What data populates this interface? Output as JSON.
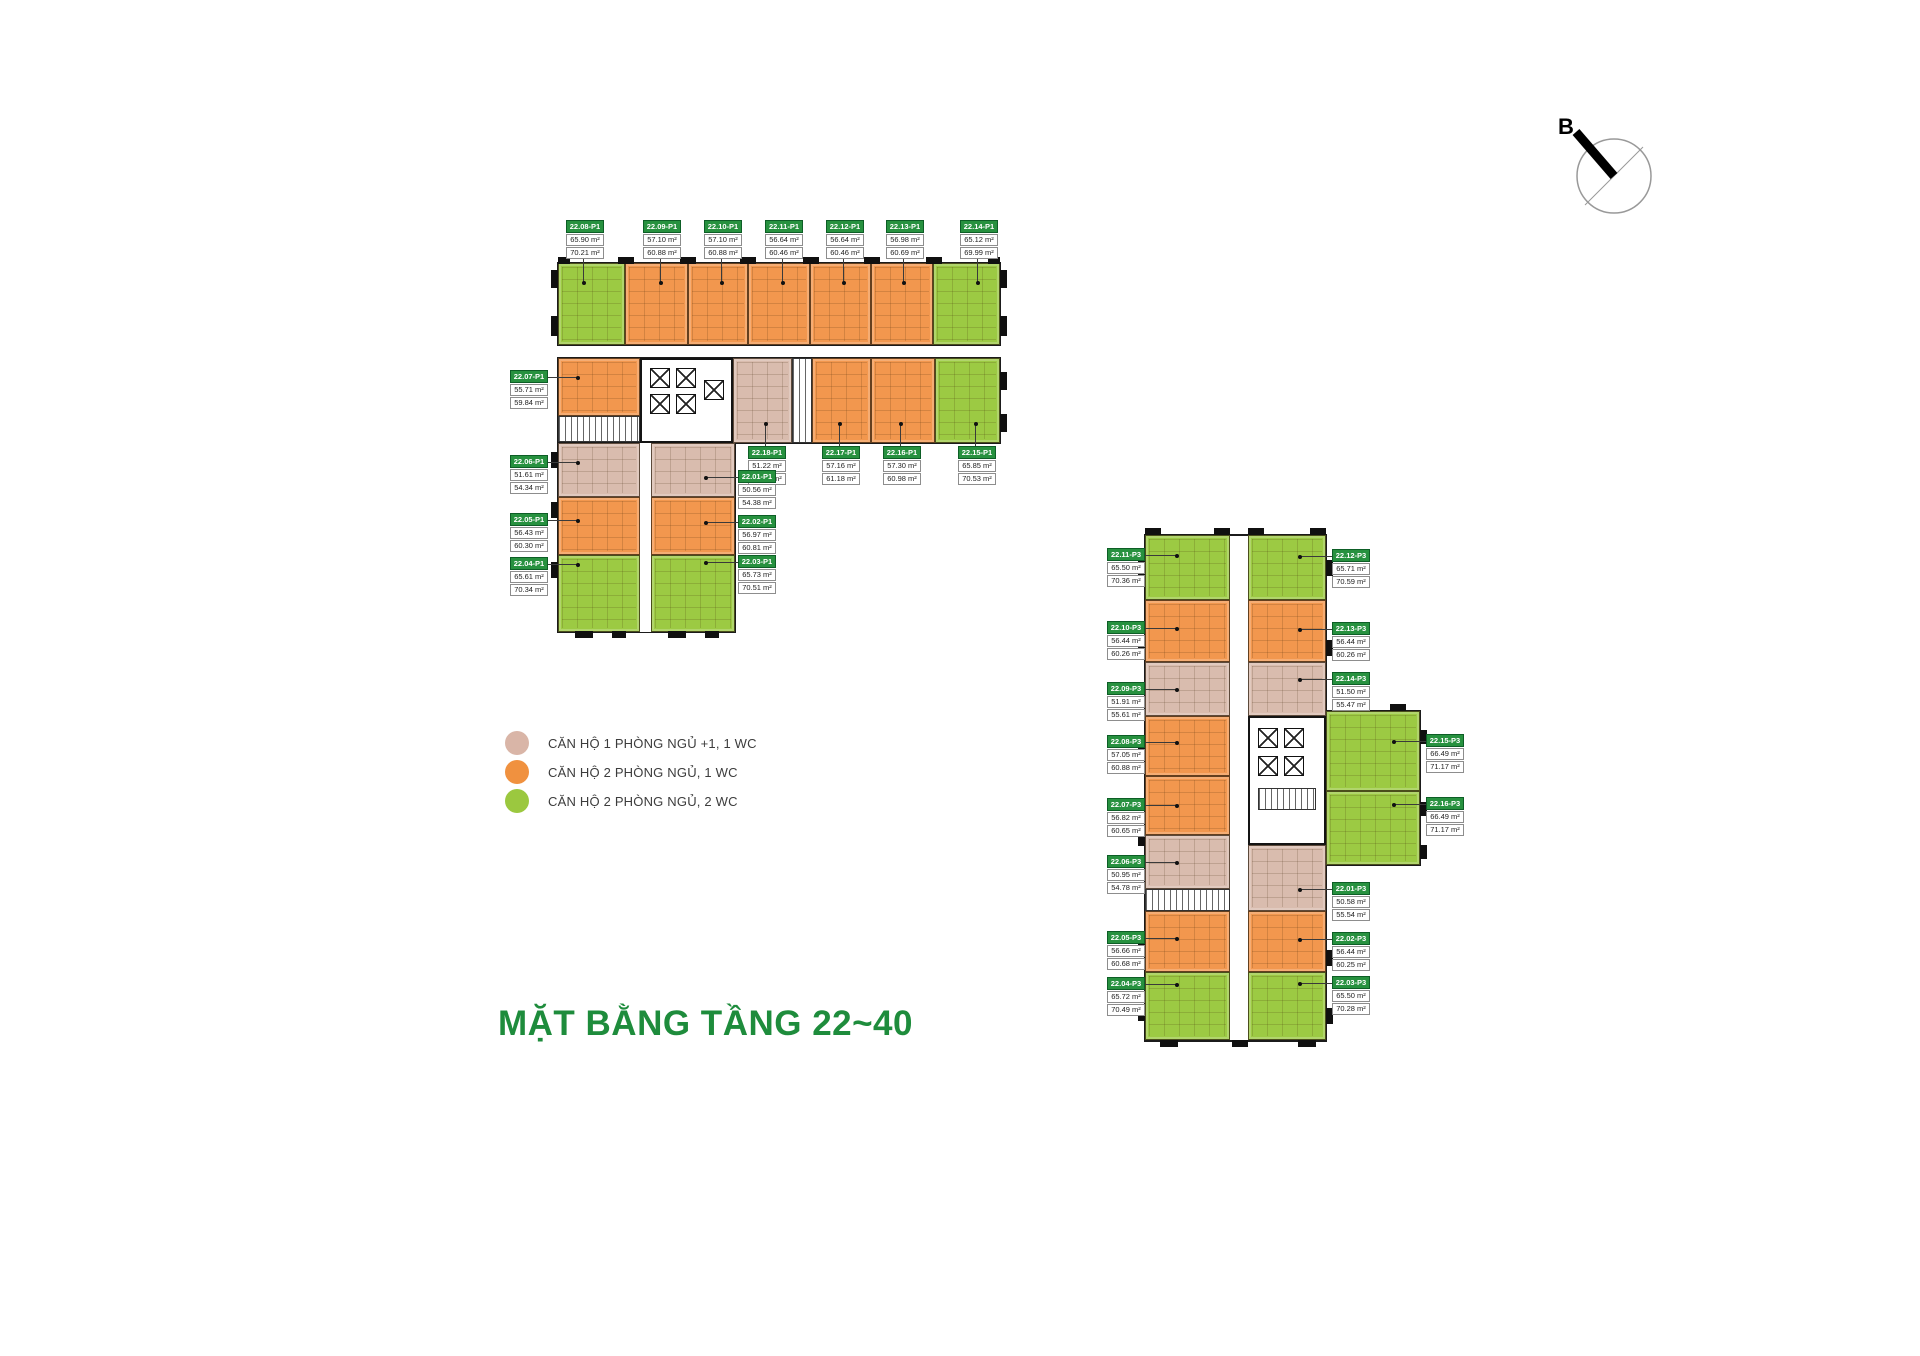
{
  "title": "MẶT BẰNG TẦNG 22~40",
  "compass": {
    "label": "B"
  },
  "colors": {
    "1pn": "#d9bcae",
    "2pn1": "#f2974e",
    "2pn2": "#9cca43",
    "label_header": "#27913f",
    "title_green": "#1e8c3c"
  },
  "legend": {
    "items": [
      {
        "label": "CĂN HỘ 1 PHÒNG NGỦ +1, 1 WC",
        "type": "1pn",
        "color": "#d9b5a7"
      },
      {
        "label": "CĂN HỘ 2 PHÒNG NGỦ, 1 WC",
        "type": "2pn1",
        "color": "#f0913f"
      },
      {
        "label": "CĂN HỘ 2 PHÒNG NGỦ, 2 WC",
        "type": "2pn2",
        "color": "#9bc83f"
      }
    ]
  },
  "buildings": {
    "p1": {
      "name": "P1",
      "units": [
        {
          "code": "22.01-P1",
          "area1": "50.56 m²",
          "area2": "54.38 m²",
          "type": "1pn"
        },
        {
          "code": "22.02-P1",
          "area1": "56.97 m²",
          "area2": "60.81 m²",
          "type": "2pn1"
        },
        {
          "code": "22.03-P1",
          "area1": "65.73 m²",
          "area2": "70.51 m²",
          "type": "2pn2"
        },
        {
          "code": "22.04-P1",
          "area1": "65.61 m²",
          "area2": "70.34 m²",
          "type": "2pn2"
        },
        {
          "code": "22.05-P1",
          "area1": "56.43 m²",
          "area2": "60.30 m²",
          "type": "2pn1"
        },
        {
          "code": "22.06-P1",
          "area1": "51.61 m²",
          "area2": "54.34 m²",
          "type": "1pn"
        },
        {
          "code": "22.07-P1",
          "area1": "55.71 m²",
          "area2": "59.84 m²",
          "type": "2pn1"
        },
        {
          "code": "22.08-P1",
          "area1": "65.90 m²",
          "area2": "70.21 m²",
          "type": "2pn2"
        },
        {
          "code": "22.09-P1",
          "area1": "57.10 m²",
          "area2": "60.88 m²",
          "type": "2pn1"
        },
        {
          "code": "22.10-P1",
          "area1": "57.10 m²",
          "area2": "60.88 m²",
          "type": "2pn1"
        },
        {
          "code": "22.11-P1",
          "area1": "56.64 m²",
          "area2": "60.46 m²",
          "type": "2pn1"
        },
        {
          "code": "22.12-P1",
          "area1": "56.64 m²",
          "area2": "60.46 m²",
          "type": "2pn1"
        },
        {
          "code": "22.13-P1",
          "area1": "56.98 m²",
          "area2": "60.69 m²",
          "type": "2pn1"
        },
        {
          "code": "22.14-P1",
          "area1": "65.12 m²",
          "area2": "69.99 m²",
          "type": "2pn2"
        },
        {
          "code": "22.15-P1",
          "area1": "65.85 m²",
          "area2": "70.53 m²",
          "type": "2pn2"
        },
        {
          "code": "22.16-P1",
          "area1": "57.30 m²",
          "area2": "60.98 m²",
          "type": "2pn1"
        },
        {
          "code": "22.17-P1",
          "area1": "57.16 m²",
          "area2": "61.18 m²",
          "type": "2pn1"
        },
        {
          "code": "22.18-P1",
          "area1": "51.22 m²",
          "area2": "55.91 m²",
          "type": "1pn"
        }
      ]
    },
    "p3": {
      "name": "P3",
      "units": [
        {
          "code": "22.01-P3",
          "area1": "50.58 m²",
          "area2": "55.54 m²",
          "type": "1pn"
        },
        {
          "code": "22.02-P3",
          "area1": "56.44 m²",
          "area2": "60.25 m²",
          "type": "2pn1"
        },
        {
          "code": "22.03-P3",
          "area1": "65.50 m²",
          "area2": "70.28 m²",
          "type": "2pn2"
        },
        {
          "code": "22.04-P3",
          "area1": "65.72 m²",
          "area2": "70.49 m²",
          "type": "2pn2"
        },
        {
          "code": "22.05-P3",
          "area1": "56.66 m²",
          "area2": "60.68 m²",
          "type": "2pn1"
        },
        {
          "code": "22.06-P3",
          "area1": "50.95 m²",
          "area2": "54.78 m²",
          "type": "1pn"
        },
        {
          "code": "22.07-P3",
          "area1": "56.82 m²",
          "area2": "60.65 m²",
          "type": "2pn1"
        },
        {
          "code": "22.08-P3",
          "area1": "57.05 m²",
          "area2": "60.88 m²",
          "type": "2pn1"
        },
        {
          "code": "22.09-P3",
          "area1": "51.91 m²",
          "area2": "55.61 m²",
          "type": "1pn"
        },
        {
          "code": "22.10-P3",
          "area1": "56.44 m²",
          "area2": "60.26 m²",
          "type": "2pn1"
        },
        {
          "code": "22.11-P3",
          "area1": "65.50 m²",
          "area2": "70.36 m²",
          "type": "2pn2"
        },
        {
          "code": "22.12-P3",
          "area1": "65.71 m²",
          "area2": "70.59 m²",
          "type": "2pn2"
        },
        {
          "code": "22.13-P3",
          "area1": "56.44 m²",
          "area2": "60.26 m²",
          "type": "2pn1"
        },
        {
          "code": "22.14-P3",
          "area1": "51.50 m²",
          "area2": "55.47 m²",
          "type": "1pn"
        },
        {
          "code": "22.15-P3",
          "area1": "66.49 m²",
          "area2": "71.17 m²",
          "type": "2pn2"
        },
        {
          "code": "22.16-P3",
          "area1": "66.49 m²",
          "area2": "71.17 m²",
          "type": "2pn2"
        }
      ]
    }
  }
}
